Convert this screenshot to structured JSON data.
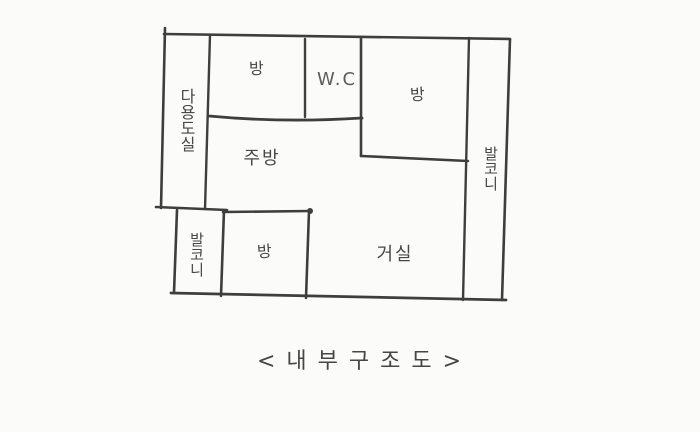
{
  "page": {
    "background": "#fbfbf9",
    "ink": "#3e3e3e"
  },
  "floor_plan": {
    "rooms": [
      {
        "name": "utility-room",
        "label": "다용도실",
        "orientation": "vertical"
      },
      {
        "name": "room-top-left",
        "label": "방",
        "orientation": "horizontal"
      },
      {
        "name": "water-closet",
        "label": "W.C",
        "orientation": "horizontal"
      },
      {
        "name": "room-top-right",
        "label": "방",
        "orientation": "horizontal"
      },
      {
        "name": "balcony-right",
        "label": "발코니",
        "orientation": "vertical"
      },
      {
        "name": "kitchen",
        "label": "주방",
        "orientation": "horizontal"
      },
      {
        "name": "balcony-lower-left",
        "label": "발코니",
        "orientation": "vertical"
      },
      {
        "name": "room-bottom",
        "label": "방",
        "orientation": "horizontal"
      },
      {
        "name": "living-room",
        "label": "거실",
        "orientation": "horizontal"
      }
    ]
  },
  "caption": "< 내 부 구 조 도 >"
}
